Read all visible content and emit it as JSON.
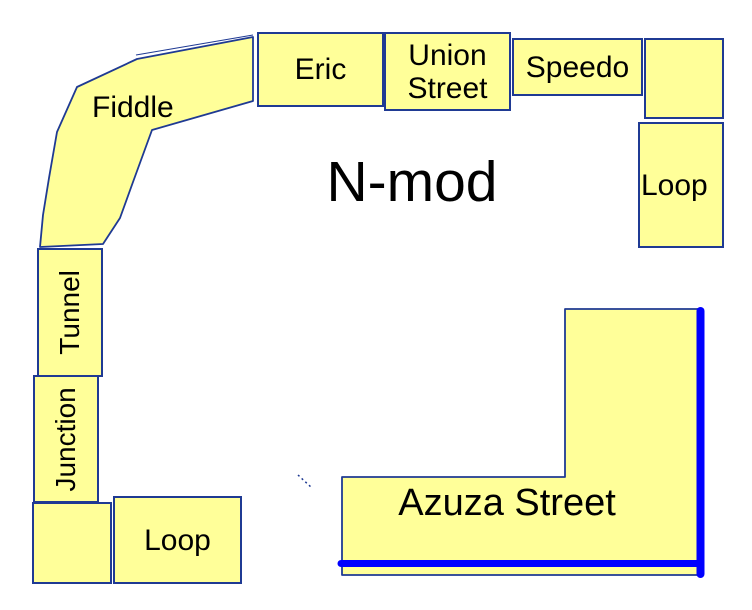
{
  "title": "N-mod",
  "colors": {
    "module_fill": "#FFFF99",
    "module_border": "#1F3A93",
    "track_line": "#0000FF",
    "text": "#000000",
    "background": "#FFFFFF"
  },
  "modules": {
    "fiddle": {
      "label": "Fiddle"
    },
    "eric": {
      "label": "Eric"
    },
    "union_street": {
      "label": "Union Street"
    },
    "speedo": {
      "label": "Speedo"
    },
    "corner_northeast": {
      "label": ""
    },
    "loop_east": {
      "label": "Loop"
    },
    "tunnel": {
      "label": "Tunnel"
    },
    "junction": {
      "label": "Junction"
    },
    "corner_southwest": {
      "label": ""
    },
    "loop_south": {
      "label": "Loop"
    },
    "azuza_street": {
      "label": "Azuza Street"
    }
  }
}
